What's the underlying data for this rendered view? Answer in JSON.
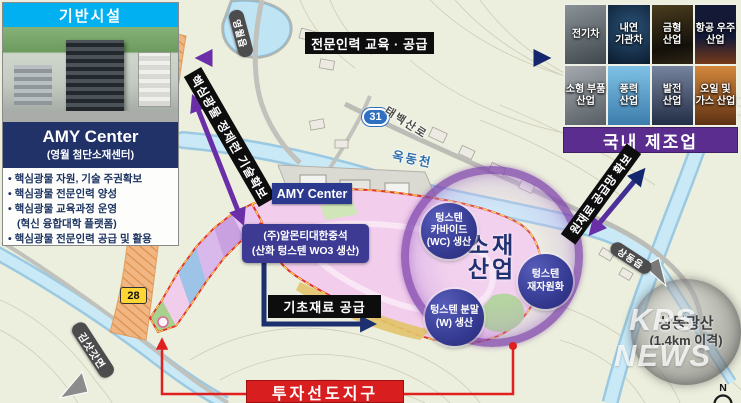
{
  "panel": {
    "title": "기반시설",
    "center_name": "AMY Center",
    "center_sub": "(영월 첨단소재센터)",
    "bullets": [
      "• 핵심광물 자원, 기술 주권확보",
      "• 핵심광물 전문인력 양성",
      "• 핵심광물 교육과정 운영",
      "(혁신 융합대학 플랫폼)",
      "• 핵심광물 전문인력 공급 및 활용"
    ]
  },
  "arrows": {
    "top_label": "전문인력 교육 · 공급",
    "left_label": "핵심광물 정제련 기술확보",
    "right_label": "원재료 공급망 확보",
    "supply_label": "기초재료 공급"
  },
  "industries": {
    "banner": "국내 제조업",
    "tiles": [
      {
        "line1": "전기차",
        "line2": ""
      },
      {
        "line1": "내연",
        "line2": "기관차"
      },
      {
        "line1": "금형",
        "line2": "산업"
      },
      {
        "line1": "항공 우주",
        "line2": "산업"
      },
      {
        "line1": "소형 부품",
        "line2": "산업"
      },
      {
        "line1": "풍력",
        "line2": "산업"
      },
      {
        "line1": "발전",
        "line2": "산업"
      },
      {
        "line1": "오일 및",
        "line2": "가스 산업"
      }
    ]
  },
  "hub": {
    "title_line1": "소재",
    "title_line2": "산업",
    "nodes": [
      {
        "line1": "텅스텐",
        "line2": "카바이드",
        "line3": "(WC) 생산"
      },
      {
        "line1": "텅스텐",
        "line2": "재자원화",
        "line3": ""
      },
      {
        "line1": "텅스텐 분말",
        "line2": "(W) 생산",
        "line3": ""
      }
    ]
  },
  "site": {
    "amy_label": "AMY Center",
    "almonty_line1": "(주)알몬티대한중석",
    "almonty_line2": "(산화 텅스텐 WO3 생산)",
    "invest_label": "투자선도지구"
  },
  "map": {
    "yeongwol": "영월읍",
    "route31": "31",
    "taebaek_road": "태백산로",
    "okdong_stream": "옥동천",
    "route28": "28",
    "gimsatgat": "김삿갓면",
    "sangdong_eup": "상동읍",
    "mine_line1": "상동광산",
    "mine_line2": "(1.4km 이격)",
    "compass": "N"
  },
  "watermark": "KPS NEWS",
  "colors": {
    "header_cyan": "#00b0f0",
    "panel_navy": "#203268",
    "banner_purple": "#5b2d8e",
    "zone_red": "#d81e1e",
    "arrow_purple": "#6a2fa8",
    "arrow_navy": "#14266e",
    "hub_ring_purple": "#7030a0",
    "node_navy": "#34378f"
  }
}
